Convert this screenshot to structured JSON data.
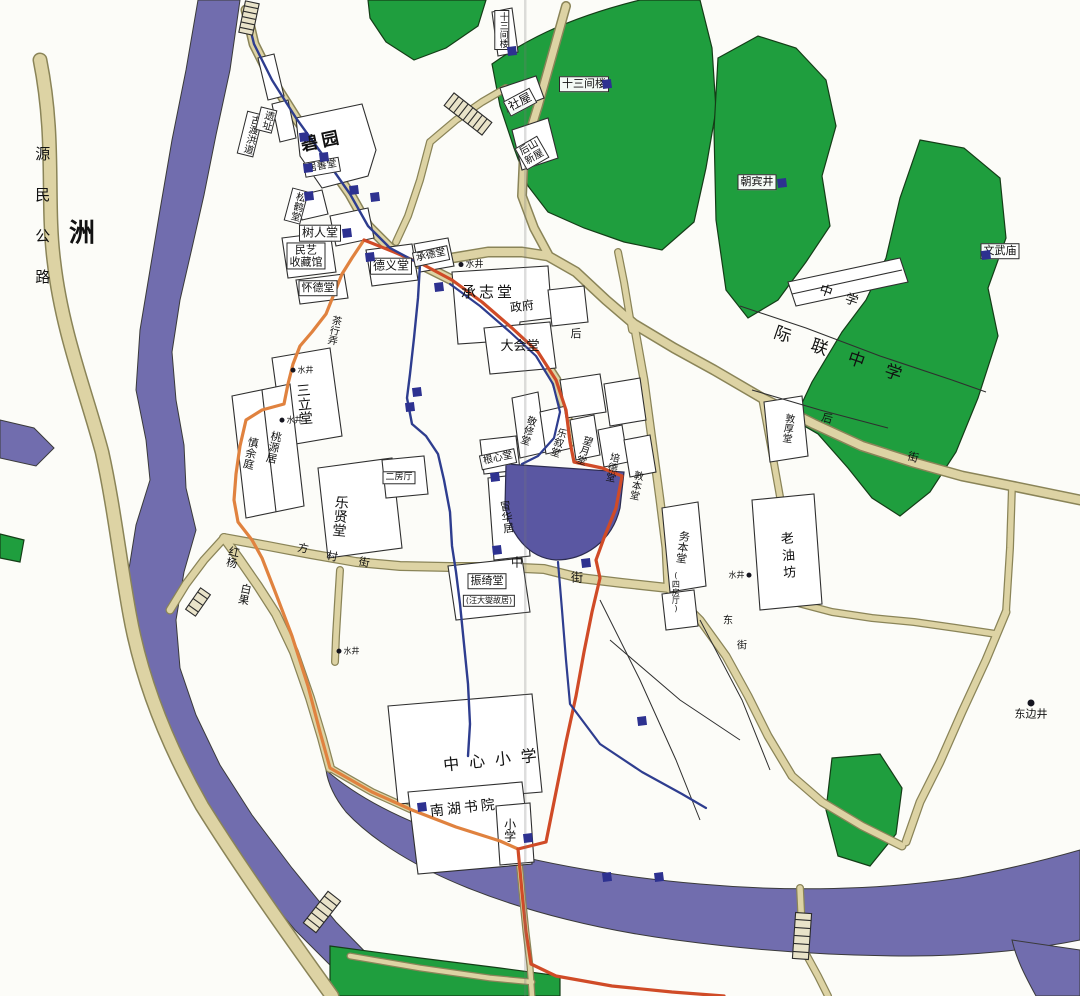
{
  "map_type": "village-tourist-map",
  "colors": {
    "water": "#716dae",
    "pond": "#5a57a2",
    "green": "#1f9e3e",
    "road_fill": "#ddd3a4",
    "road_edge": "#8a8458",
    "route_red": "#d04b27",
    "route_orange": "#e0823f",
    "channel_blue": "#2e3d8f",
    "marker": "#2d3190",
    "label_text": "#111111"
  },
  "labels": [
    {
      "text": "源民公路",
      "x": 42,
      "y": 228,
      "o": "v",
      "s": 15,
      "ls": 26,
      "type": "road"
    },
    {
      "text": "洲",
      "x": 82,
      "y": 234,
      "s": 26,
      "bold": true,
      "type": "area"
    },
    {
      "text": "古渡洪道",
      "x": 250,
      "y": 134,
      "o": "v",
      "s": 10,
      "b": true,
      "r": 14,
      "type": "site"
    },
    {
      "text": "遗址",
      "x": 266,
      "y": 120,
      "o": "v",
      "s": 10,
      "b": true,
      "r": 14,
      "type": "site"
    },
    {
      "text": "碧园",
      "x": 322,
      "y": 142,
      "s": 17,
      "r": -12,
      "ls": 4,
      "bold": true,
      "type": "hall"
    },
    {
      "text": "十三间楼",
      "x": 502,
      "y": 30,
      "o": "v",
      "s": 9,
      "b": true,
      "type": "hall"
    },
    {
      "text": "社屋",
      "x": 520,
      "y": 102,
      "s": 12,
      "b": true,
      "r": -28,
      "type": "hall"
    },
    {
      "text": "十三间楼",
      "x": 584,
      "y": 84,
      "s": 11,
      "b": true,
      "type": "hall"
    },
    {
      "text": "后山\n新屋",
      "x": 532,
      "y": 153,
      "s": 10,
      "b": true,
      "r": -30,
      "type": "hall"
    },
    {
      "text": "朝宾井",
      "x": 757,
      "y": 182,
      "s": 11,
      "b": true,
      "type": "well"
    },
    {
      "text": "文武庙",
      "x": 1000,
      "y": 251,
      "s": 11,
      "b": true,
      "type": "site"
    },
    {
      "text": "中学",
      "x": 845,
      "y": 299,
      "s": 13,
      "r": 19,
      "ls": 14,
      "type": "school"
    },
    {
      "text": "际联中学",
      "x": 848,
      "y": 358,
      "s": 17,
      "r": 19,
      "ls": 22,
      "type": "school"
    },
    {
      "text": "居善堂",
      "x": 322,
      "y": 167,
      "s": 10,
      "b": true,
      "r": -10,
      "type": "hall"
    },
    {
      "text": "松鹤堂",
      "x": 296,
      "y": 206,
      "o": "v",
      "s": 10,
      "b": true,
      "r": 15,
      "type": "hall"
    },
    {
      "text": "树人堂",
      "x": 320,
      "y": 233,
      "s": 12,
      "b": true,
      "type": "hall"
    },
    {
      "text": "民艺\n收藏馆",
      "x": 306,
      "y": 256,
      "s": 11,
      "b": true,
      "type": "hall"
    },
    {
      "text": "怀德堂",
      "x": 318,
      "y": 288,
      "s": 11,
      "b": true,
      "type": "hall"
    },
    {
      "text": "德义堂",
      "x": 391,
      "y": 266,
      "s": 12,
      "b": true,
      "type": "hall"
    },
    {
      "text": "承德堂",
      "x": 431,
      "y": 256,
      "s": 10,
      "b": true,
      "r": -12,
      "type": "hall"
    },
    {
      "text": "水井",
      "x": 470,
      "y": 266,
      "s": 9,
      "dot": "l",
      "type": "well"
    },
    {
      "text": "承志堂",
      "x": 488,
      "y": 292,
      "s": 15,
      "ls": 3,
      "type": "hall"
    },
    {
      "text": "政府",
      "x": 522,
      "y": 307,
      "s": 12,
      "r": -8,
      "type": "building"
    },
    {
      "text": "大会堂",
      "x": 520,
      "y": 347,
      "s": 13,
      "type": "building"
    },
    {
      "text": "茶行弄",
      "x": 333,
      "y": 330,
      "o": "v",
      "s": 10,
      "r": 12,
      "type": "street"
    },
    {
      "text": "水井",
      "x": 301,
      "y": 371,
      "s": 8,
      "dot": "l",
      "type": "well"
    },
    {
      "text": "三立堂",
      "x": 303,
      "y": 404,
      "o": "v",
      "s": 14,
      "r": -5,
      "type": "hall"
    },
    {
      "text": "水井",
      "x": 290,
      "y": 421,
      "s": 8,
      "dot": "l",
      "type": "well"
    },
    {
      "text": "桃源居",
      "x": 273,
      "y": 447,
      "o": "v",
      "s": 11,
      "r": 12,
      "type": "hall"
    },
    {
      "text": "慎余庭",
      "x": 250,
      "y": 453,
      "o": "v",
      "s": 11,
      "r": 12,
      "type": "hall"
    },
    {
      "text": "乐贤堂",
      "x": 339,
      "y": 516,
      "o": "v",
      "s": 14,
      "r": 5,
      "type": "hall"
    },
    {
      "text": "二房厅",
      "x": 399,
      "y": 478,
      "s": 9,
      "b": true,
      "type": "hall"
    },
    {
      "text": "根心堂",
      "x": 498,
      "y": 459,
      "s": 10,
      "b": true,
      "r": -12,
      "type": "hall"
    },
    {
      "text": "敬修堂",
      "x": 527,
      "y": 430,
      "o": "v",
      "s": 10,
      "r": 18,
      "type": "hall"
    },
    {
      "text": "乐叙堂",
      "x": 557,
      "y": 442,
      "o": "v",
      "s": 10,
      "r": 18,
      "type": "hall"
    },
    {
      "text": "望月堂",
      "x": 583,
      "y": 450,
      "o": "v",
      "s": 10,
      "r": 18,
      "type": "hall"
    },
    {
      "text": "培德堂",
      "x": 611,
      "y": 467,
      "o": "v",
      "s": 10,
      "r": 12,
      "type": "hall"
    },
    {
      "text": "敦本堂",
      "x": 635,
      "y": 485,
      "o": "v",
      "s": 10,
      "r": 12,
      "type": "hall"
    },
    {
      "text": "敦厚堂",
      "x": 787,
      "y": 428,
      "o": "v",
      "s": 10,
      "r": 8,
      "type": "hall"
    },
    {
      "text": "冒华居",
      "x": 506,
      "y": 517,
      "o": "v",
      "s": 11,
      "r": -8,
      "type": "hall"
    },
    {
      "text": "务本堂",
      "x": 682,
      "y": 547,
      "o": "v",
      "s": 11,
      "r": 8,
      "type": "hall"
    },
    {
      "text": "(四房厅)",
      "x": 675,
      "y": 592,
      "o": "v",
      "s": 8,
      "type": "hall"
    },
    {
      "text": "水井",
      "x": 741,
      "y": 576,
      "s": 8,
      "dot": "r",
      "type": "well"
    },
    {
      "text": "老油坊",
      "x": 786,
      "y": 557,
      "o": "v",
      "s": 13,
      "ls": 4,
      "r": -4,
      "type": "hall"
    },
    {
      "text": "红杨",
      "x": 232,
      "y": 557,
      "o": "v",
      "s": 11,
      "r": 12,
      "type": "tree"
    },
    {
      "text": "白果",
      "x": 244,
      "y": 594,
      "o": "v",
      "s": 11,
      "r": 12,
      "type": "tree"
    },
    {
      "text": "振绮堂",
      "x": 487,
      "y": 581,
      "s": 11,
      "b": true,
      "type": "hall"
    },
    {
      "text": "(汪大燮故居)",
      "x": 489,
      "y": 601,
      "s": 8,
      "b": true,
      "type": "hall"
    },
    {
      "text": "中",
      "x": 517,
      "y": 563,
      "s": 12,
      "type": "street"
    },
    {
      "text": "街",
      "x": 577,
      "y": 578,
      "s": 12,
      "type": "street"
    },
    {
      "text": "方",
      "x": 303,
      "y": 549,
      "s": 11,
      "r": 12,
      "type": "street"
    },
    {
      "text": "村",
      "x": 332,
      "y": 557,
      "s": 11,
      "r": 12,
      "type": "street"
    },
    {
      "text": "街",
      "x": 364,
      "y": 563,
      "s": 11,
      "r": 12,
      "type": "street"
    },
    {
      "text": "后",
      "x": 576,
      "y": 334,
      "s": 11,
      "type": "street"
    },
    {
      "text": "后",
      "x": 827,
      "y": 419,
      "s": 11,
      "r": 15,
      "type": "street"
    },
    {
      "text": "街",
      "x": 913,
      "y": 458,
      "s": 11,
      "r": 15,
      "type": "street"
    },
    {
      "text": "东",
      "x": 728,
      "y": 621,
      "s": 10,
      "type": "street"
    },
    {
      "text": "街",
      "x": 742,
      "y": 646,
      "s": 10,
      "type": "street"
    },
    {
      "text": "东边井",
      "x": 1031,
      "y": 710,
      "s": 11,
      "dot": "t",
      "type": "well"
    },
    {
      "text": "中心小学",
      "x": 495,
      "y": 760,
      "s": 16,
      "ls": 10,
      "r": -6,
      "type": "school"
    },
    {
      "text": "南湖书院",
      "x": 464,
      "y": 809,
      "s": 14,
      "ls": 3,
      "r": -6,
      "type": "school"
    },
    {
      "text": "小学",
      "x": 509,
      "y": 830,
      "o": "v",
      "s": 12,
      "type": "school"
    },
    {
      "text": "水井",
      "x": 347,
      "y": 652,
      "s": 8,
      "dot": "l",
      "type": "well"
    }
  ],
  "markers": [
    {
      "x": 304,
      "y": 137
    },
    {
      "x": 324,
      "y": 157
    },
    {
      "x": 308,
      "y": 168
    },
    {
      "x": 309,
      "y": 196
    },
    {
      "x": 354,
      "y": 190
    },
    {
      "x": 375,
      "y": 197
    },
    {
      "x": 347,
      "y": 233
    },
    {
      "x": 370,
      "y": 257
    },
    {
      "x": 439,
      "y": 287
    },
    {
      "x": 417,
      "y": 392
    },
    {
      "x": 410,
      "y": 407
    },
    {
      "x": 495,
      "y": 477
    },
    {
      "x": 497,
      "y": 550
    },
    {
      "x": 586,
      "y": 563
    },
    {
      "x": 642,
      "y": 721
    },
    {
      "x": 422,
      "y": 807
    },
    {
      "x": 528,
      "y": 838
    },
    {
      "x": 607,
      "y": 877
    },
    {
      "x": 659,
      "y": 877
    },
    {
      "x": 512,
      "y": 51
    },
    {
      "x": 607,
      "y": 84
    },
    {
      "x": 782,
      "y": 183
    },
    {
      "x": 986,
      "y": 255
    }
  ]
}
